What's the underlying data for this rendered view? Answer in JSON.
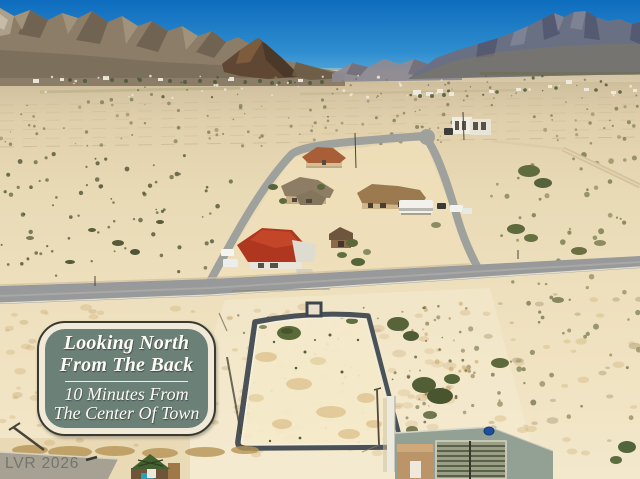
{
  "overlay": {
    "info_box": {
      "line1": "Looking North",
      "line2": "From The Back",
      "line3": "10 Minutes From",
      "line4": "The Center Of Town"
    },
    "watermark": {
      "text": "LVR 2026"
    }
  },
  "palette": {
    "infobox_bg": "#6b8077",
    "infobox_frame": "#f2ead8",
    "infobox_outline": "#3a3a30",
    "infobox_text": "#fdfcf4",
    "watermark_color": "#6b6e66",
    "sky_top": "#0e6cbe",
    "sky_horizon": "#7fc0e4",
    "desert_far": "#c6b694",
    "desert_near": "#f3e8cc",
    "road_gray": "#97999a",
    "lot_outline": "#4a5257",
    "lot_fill": "#f4e9ca",
    "scrub_green": "#5e6a3c",
    "mountain_left": "#8b7d68",
    "mountain_right": "#697083"
  }
}
